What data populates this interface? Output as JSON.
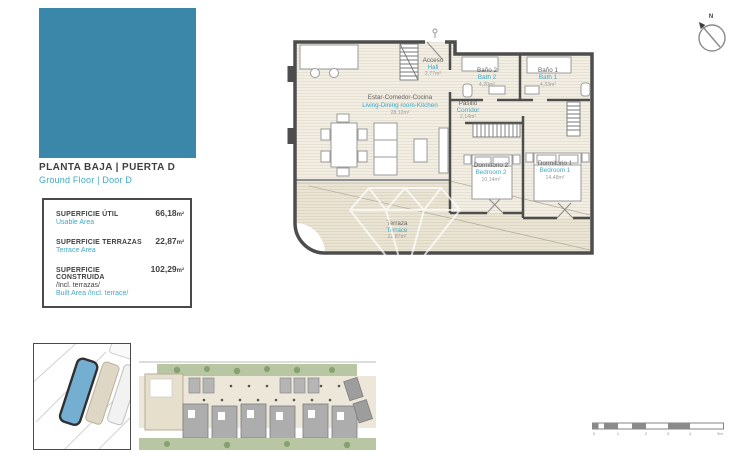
{
  "colors": {
    "brand_teal_block": "#3b87a9",
    "text_teal": "#3fa9c6",
    "text_dark": "#3f3f3f",
    "wall": "#4d4d4d",
    "floor_beige": "#f2eee3",
    "terrace_beige": "#eae4d4",
    "site_green": "#b8c6a3",
    "site_building_gray": "#adadad",
    "highlighted_building": "#74aed0"
  },
  "header": {
    "title_es": "PLANTA BAJA | PUERTA D",
    "title_en": "Ground Floor | Door D"
  },
  "areas_box": {
    "rows": [
      {
        "label_es": "SUPERFICIE ÚTIL",
        "label_en": "Usable Area",
        "value": "66,18",
        "unit": "m²"
      },
      {
        "label_es": "SUPERFICIE TERRAZAS",
        "label_en": "Terrace Area",
        "value": "22,87",
        "unit": "m²"
      },
      {
        "label_es": "SUPERFICIE CONSTRUIDA",
        "label_es_extra": "/Incl. terrazas/",
        "label_en": "Built Area /Incl. terrace/",
        "value": "102,29",
        "unit": "m²"
      }
    ]
  },
  "floorplan": {
    "compass_label": "N",
    "watermark_icon": "diamond-gem",
    "rooms": [
      {
        "name_es": "Estar-Comedor-Cocina",
        "name_en": "Living-Dining room-Kitchen",
        "area": "28,12m²"
      },
      {
        "name_es": "Acceso",
        "name_en": "Hall",
        "area": "2,77m²"
      },
      {
        "name_es": "Baño 2",
        "name_en": "Bath 2",
        "area": "4,20m²"
      },
      {
        "name_es": "Baño 1",
        "name_en": "Bath 1",
        "area": "4,33m²"
      },
      {
        "name_es": "Pasillo",
        "name_en": "Corridor",
        "area": "2,14m²"
      },
      {
        "name_es": "Dormitorio 2",
        "name_en": "Bedroom 2",
        "area": "10,14m²"
      },
      {
        "name_es": "Dormitorio 1",
        "name_en": "Bedroom 1",
        "area": "14,48m²"
      },
      {
        "name_es": "Terraza",
        "name_en": "Terrace",
        "area": "22,87m²"
      }
    ]
  },
  "scale_bar": {
    "labels": [
      "0",
      "1",
      "2",
      "3",
      "4",
      "5m"
    ]
  }
}
